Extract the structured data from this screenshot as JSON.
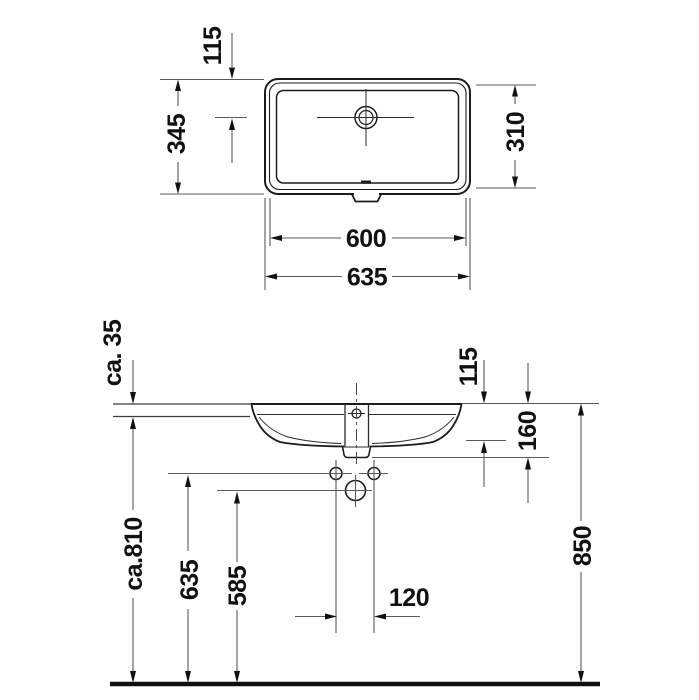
{
  "title": "Washbasin technical dimension drawing",
  "colors": {
    "line": "#1c1c1c",
    "dimension_line": "#5a5a5a",
    "text": "#111111",
    "background": "#ffffff"
  },
  "top_view": {
    "labels": {
      "drain_offset": "115",
      "depth_outer": "345",
      "depth_inner": "310",
      "width_inner": "600",
      "width_outer": "635"
    }
  },
  "front_view": {
    "labels": {
      "counter_thickness": "ca. 35",
      "rim_to_underside": "115",
      "rim_to_outlet": "160",
      "rim_height": "850",
      "counter_underside_height": "ca.810",
      "fixing_holes_height": "635",
      "drain_height": "585",
      "fixing_holes_spacing": "120"
    }
  }
}
